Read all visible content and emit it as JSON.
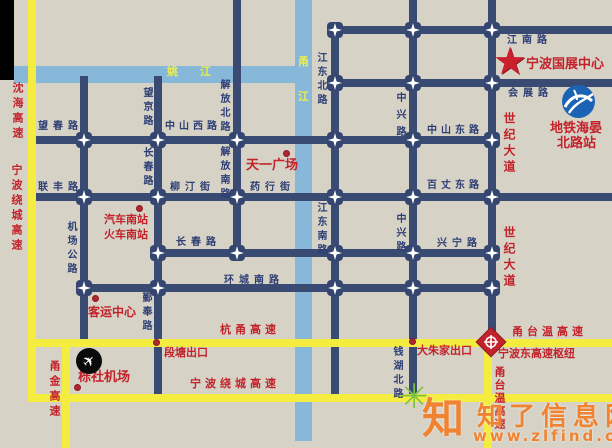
{
  "rivers": {
    "yao": "姚江",
    "yong_top": "甬",
    "yong_bottom": "江"
  },
  "roads": {
    "wangchun": "望春路",
    "zhongshan_w": "中山西路",
    "zhongshan_e": "中山东路",
    "wangjing": "望京路",
    "jiefang_n": "解放北路",
    "jiefang_s": "解放南路",
    "changchun": "长春路",
    "lianfeng": "联丰路",
    "liuting": "柳汀街",
    "yaohang": "药行街",
    "jichang": "机场公路",
    "huancheng": "环城南路",
    "yinfeng": "鄞奉路",
    "jiangdong_n": "江东北路",
    "jiangdong_s": "江东南路",
    "zhongxing": "中兴路",
    "baizhang": "百丈东路",
    "xingning": "兴宁路",
    "jiangnan": "江南路",
    "huizhan": "会展路",
    "qianhu": "钱湖北路",
    "shiji": "世纪大道"
  },
  "highways": {
    "shenhai": "沈海高速",
    "raocheng": "宁波绕城高速",
    "hangyong": "杭甬高速",
    "yongjin": "甬金高速",
    "yongtaiwen": "甬台温高速"
  },
  "exits": {
    "duantang": "段塘出口",
    "dazhujia": "大朱家出口",
    "hub": "宁波东高速枢纽"
  },
  "pois": {
    "tianyi_square": "天一广场",
    "south_bus_station": "汽车南站",
    "south_train_station": "火车南站",
    "passenger_center": "客运中心",
    "lishe_airport": "栎社机场",
    "expo_center": "宁波国展中心",
    "metro_station_line1": "地铁海晏",
    "metro_station_line2": "北路站"
  },
  "watermark": {
    "site_name": "知了信息网",
    "site_url": "www.zlfind.com",
    "logo_char": "知"
  },
  "colors": {
    "background": "#d6d2c6",
    "city_road": "#3a4b73",
    "expressway": "#f4ec3e",
    "river": "#87b8da",
    "red_label": "#c3222b",
    "navy_label": "#2c3e74"
  }
}
